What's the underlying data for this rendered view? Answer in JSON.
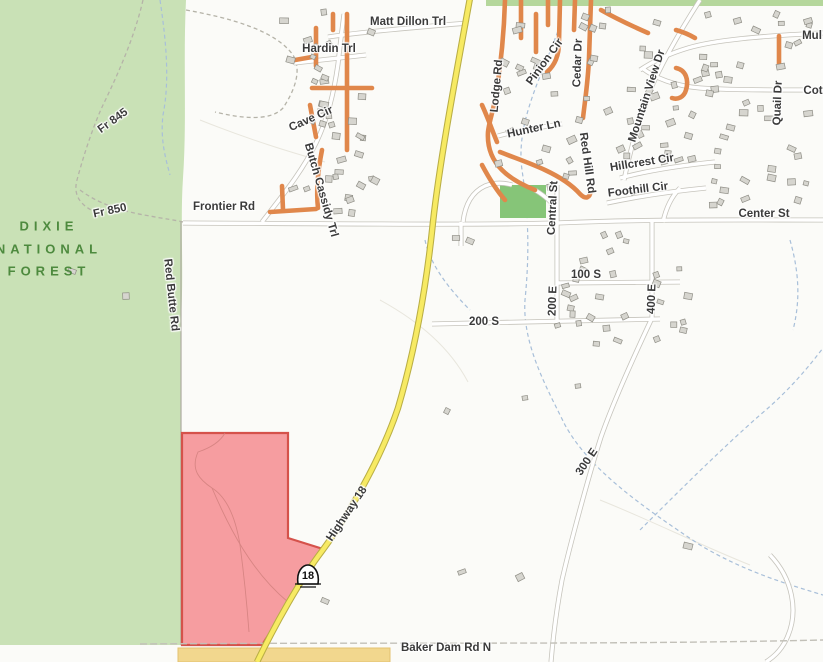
{
  "map": {
    "title": "Topographic street map, Dixie National Forest / Highway 18 area",
    "labels": [
      {
        "id": "matt-dillon-trl",
        "text": "Matt Dillon Trl",
        "x": 408,
        "y": 22,
        "r": 0
      },
      {
        "id": "hardin-trl",
        "text": "Hardin Trl",
        "x": 329,
        "y": 49,
        "r": 0
      },
      {
        "id": "cave-cir",
        "text": "Cave Cir",
        "x": 311,
        "y": 119,
        "r": -24
      },
      {
        "id": "butch-cassidy-trl",
        "text": "Butch Cassidy Trl",
        "x": 321,
        "y": 190,
        "r": 74
      },
      {
        "id": "lodge-rd",
        "text": "Lodge Rd",
        "x": 497,
        "y": 86,
        "r": -85
      },
      {
        "id": "pinion-cir",
        "text": "Pinion Cir",
        "x": 545,
        "y": 62,
        "r": -54
      },
      {
        "id": "cedar-dr",
        "text": "Cedar Dr",
        "x": 578,
        "y": 63,
        "r": -88
      },
      {
        "id": "hunter-ln",
        "text": "Hunter Ln",
        "x": 534,
        "y": 129,
        "r": -12
      },
      {
        "id": "red-hill-rd",
        "text": "Red Hill Rd",
        "x": 587,
        "y": 163,
        "r": 82
      },
      {
        "id": "mountain-view-dr",
        "text": "Mountain View Dr",
        "x": 647,
        "y": 96,
        "r": -72
      },
      {
        "id": "quail-dr",
        "text": "Quail Dr",
        "x": 778,
        "y": 103,
        "r": -88
      },
      {
        "id": "mul",
        "text": "Mul",
        "x": 812,
        "y": 36,
        "r": 0
      },
      {
        "id": "cot",
        "text": "Cot",
        "x": 813,
        "y": 91,
        "r": 0
      },
      {
        "id": "hillcrest-cir",
        "text": "Hillcrest Cir",
        "x": 642,
        "y": 163,
        "r": -9
      },
      {
        "id": "foothill-cir",
        "text": "Foothill Cir",
        "x": 638,
        "y": 190,
        "r": -7
      },
      {
        "id": "center-st",
        "text": "Center St",
        "x": 764,
        "y": 214,
        "r": 0
      },
      {
        "id": "central-st",
        "text": "Central St",
        "x": 553,
        "y": 208,
        "r": -87
      },
      {
        "id": "frontier-rd",
        "text": "Frontier Rd",
        "x": 224,
        "y": 207,
        "r": 0
      },
      {
        "id": "100-s",
        "text": "100 S",
        "x": 586,
        "y": 275,
        "r": 0
      },
      {
        "id": "200-e",
        "text": "200 E",
        "x": 553,
        "y": 301,
        "r": -88
      },
      {
        "id": "400-e",
        "text": "400 E",
        "x": 652,
        "y": 299,
        "r": -88
      },
      {
        "id": "200-s",
        "text": "200 S",
        "x": 484,
        "y": 322,
        "r": 0
      },
      {
        "id": "300-e",
        "text": "300 E",
        "x": 587,
        "y": 462,
        "r": -56
      },
      {
        "id": "highway-18",
        "text": "Highway 18",
        "x": 347,
        "y": 514,
        "r": -56
      },
      {
        "id": "baker-dam-rd-n",
        "text": "Baker Dam Rd N",
        "x": 446,
        "y": 648,
        "r": 0
      },
      {
        "id": "fr-845",
        "text": "Fr 845",
        "x": 113,
        "y": 121,
        "r": -36
      },
      {
        "id": "fr-850",
        "text": "Fr 850",
        "x": 110,
        "y": 211,
        "r": -12
      },
      {
        "id": "red-butte-rd",
        "text": "Red Butte Rd",
        "x": 171,
        "y": 295,
        "r": 84
      },
      {
        "id": "forest-line1",
        "text": "DIXIE",
        "x": 49,
        "y": 226,
        "r": 0,
        "cls": "forest-lbl"
      },
      {
        "id": "forest-line2",
        "text": "NATIONAL",
        "x": 49,
        "y": 249,
        "r": 0,
        "cls": "forest-lbl"
      },
      {
        "id": "forest-line3",
        "text": "FOREST",
        "x": 49,
        "y": 271,
        "r": 0,
        "cls": "forest-lbl"
      }
    ]
  },
  "shield": {
    "route": "18"
  },
  "colors": {
    "forest": "#c9e1b6",
    "forest_strip": "#b5d79c",
    "forest_label": "#4d8a3e",
    "road_casing": "#c6c4bc",
    "road_fill": "#ffffff",
    "orange_road": "#e0874b",
    "highway_fill": "#f7ea63",
    "highway_casing": "#b9ae45",
    "stream": "#a8bfd9",
    "building_fill": "#d6d5cf",
    "building_stroke": "#8f8e86",
    "parcel_red_fill": "#f59296",
    "parcel_red_stroke": "#d5524b",
    "parcel_tan_fill": "#f2d78e",
    "parcel_tan_stroke": "#e3c270",
    "park": "#86c578",
    "dashed_track": "#b5b3a8"
  }
}
